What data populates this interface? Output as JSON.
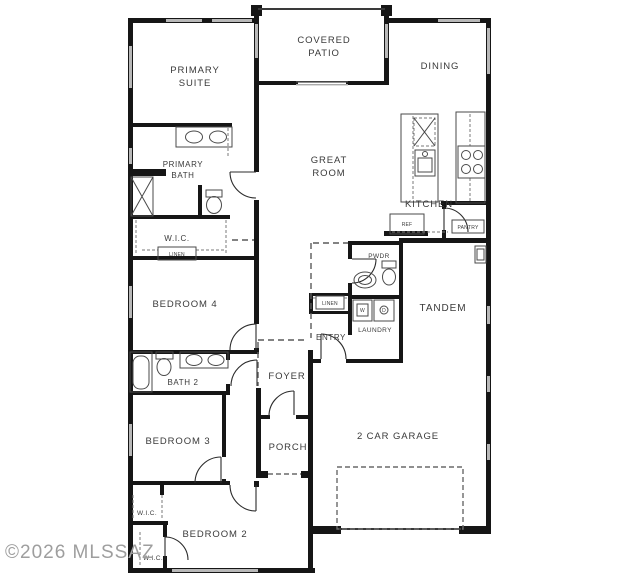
{
  "watermark": "©2026 MLSSAZ",
  "rooms": {
    "primary_suite_1": "PRIMARY",
    "primary_suite_2": "SUITE",
    "covered_patio_1": "COVERED",
    "covered_patio_2": "PATIO",
    "dining": "DINING",
    "primary_bath_1": "PRIMARY",
    "primary_bath_2": "BATH",
    "wic_primary": "W.I.C.",
    "linen_primary": "LINEN",
    "great_room_1": "GREAT",
    "great_room_2": "ROOM",
    "kitchen": "KITCHEN",
    "ref": "REF",
    "pantry": "PANTRY",
    "pwdr": "PWDR",
    "tandem": "TANDEM",
    "linen_hall": "LINEN",
    "washer": "W",
    "dryer": "D",
    "laundry": "LAUNDRY",
    "entry": "ENTRY",
    "bedroom4": "BEDROOM 4",
    "bath2": "BATH 2",
    "foyer": "FOYER",
    "porch": "PORCH",
    "bedroom3": "BEDROOM 3",
    "wic_hall": "W.I.C.",
    "bedroom2": "BEDROOM 2",
    "wic_bedroom2": "W.I.C.",
    "garage": "2 CAR GARAGE"
  },
  "colors": {
    "wall": "#161616",
    "window": "#b8b8b8",
    "label": "#3a3a3a",
    "watermark": "#9e9e9e",
    "dashed": "#7a7a7a",
    "background": "#ffffff"
  }
}
